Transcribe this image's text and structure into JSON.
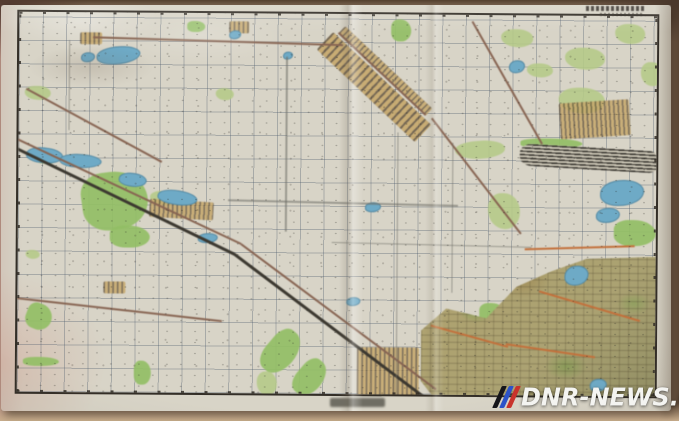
{
  "meta": {
    "description": "Photograph of a paper topographic map sheet on a table; map lettering is illegible at this resolution",
    "watermark": {
      "text": "DNR-NEWS.COM",
      "logo": "three-slanted-stripes-flag"
    }
  },
  "palette": {
    "table": "#b59a82",
    "table-dark": "#553b31",
    "table-pink": "#c39a8d",
    "table-bottom": "#c9ae8d",
    "paper": "#d8d4c7",
    "frame": "#332e27",
    "grid": "rgba(76,90,108,0.35)",
    "forest": "#b4cb82",
    "forest-bright": "#90c05e",
    "water": "#6aabc9",
    "urban-fill": "#c9a866",
    "urban-hatch": "rgba(80,62,38,0.8)",
    "city-base": "#aca26e",
    "rail": "#3c382f",
    "road": "#8a6450",
    "highway": "#c96f35",
    "track": "#6f6f68",
    "wm-text": "#f4f4f1",
    "wm-black": "#15151a",
    "wm-blue": "#2c53c8",
    "wm-red": "#c8332b"
  },
  "map": {
    "grid_spacing_px": 23.5,
    "features": [
      {
        "n": "forest-patch",
        "k": "forest",
        "x": 6,
        "y": 74,
        "w": 26,
        "h": 14
      },
      {
        "n": "forest-patch",
        "k": "forest2",
        "x": 168,
        "y": 8,
        "w": 18,
        "h": 11
      },
      {
        "n": "forest-patch",
        "k": "forest2",
        "x": 372,
        "y": 5,
        "w": 20,
        "h": 22
      },
      {
        "n": "forest-patch",
        "k": "forest",
        "x": 482,
        "y": 14,
        "w": 32,
        "h": 18
      },
      {
        "n": "forest-patch",
        "k": "forest",
        "x": 596,
        "y": 8,
        "w": 30,
        "h": 20
      },
      {
        "n": "forest-patch",
        "k": "forest",
        "x": 540,
        "y": 72,
        "w": 46,
        "h": 26
      },
      {
        "n": "forest-patch",
        "k": "forest",
        "x": 622,
        "y": 46,
        "w": 22,
        "h": 24
      },
      {
        "n": "forest-patch",
        "k": "forest",
        "x": 546,
        "y": 32,
        "w": 40,
        "h": 22
      },
      {
        "n": "forest-patch",
        "k": "forest",
        "x": 508,
        "y": 48,
        "w": 26,
        "h": 14
      },
      {
        "n": "big-forest",
        "k": "forest2",
        "x": 60,
        "y": 164,
        "w": 66,
        "h": 58,
        "r": -8
      },
      {
        "n": "forest-patch",
        "k": "forest2",
        "x": 92,
        "y": 213,
        "w": 40,
        "h": 22
      },
      {
        "n": "forest-patch",
        "k": "forest",
        "x": 12,
        "y": 136,
        "w": 30,
        "h": 16
      },
      {
        "n": "forest-patch",
        "k": "forest",
        "x": 132,
        "y": 178,
        "w": 30,
        "h": 14
      },
      {
        "n": "forest-patch",
        "k": "forest",
        "x": 436,
        "y": 128,
        "w": 50,
        "h": 18,
        "r": -5
      },
      {
        "n": "forest-patch",
        "k": "forest",
        "x": 470,
        "y": 178,
        "w": 32,
        "h": 36
      },
      {
        "n": "forest-patch",
        "k": "forest2",
        "x": 596,
        "y": 204,
        "w": 42,
        "h": 26
      },
      {
        "n": "forest-strip",
        "k": "forest2",
        "x": 502,
        "y": 123,
        "w": 62,
        "h": 10
      },
      {
        "n": "forest-strip",
        "k": "forest2",
        "x": 268,
        "y": 310,
        "w": 30,
        "h": 48,
        "r": 40
      },
      {
        "n": "forest-strip",
        "k": "forest2",
        "x": 296,
        "y": 340,
        "w": 26,
        "h": 40,
        "r": 40
      },
      {
        "n": "forest-patch",
        "k": "forest",
        "x": 240,
        "y": 358,
        "w": 20,
        "h": 24
      },
      {
        "n": "city-park",
        "k": "forest2",
        "x": 462,
        "y": 288,
        "w": 26,
        "h": 20
      },
      {
        "n": "city-park",
        "k": "forest2",
        "x": 524,
        "y": 318,
        "w": 30,
        "h": 22
      },
      {
        "n": "city-park",
        "k": "forest2",
        "x": 594,
        "y": 338,
        "w": 28,
        "h": 20
      },
      {
        "n": "city-park",
        "k": "forest2",
        "x": 634,
        "y": 288,
        "w": 20,
        "h": 26
      },
      {
        "n": "city-park",
        "k": "forest2",
        "x": 574,
        "y": 248,
        "w": 24,
        "h": 16
      },
      {
        "n": "forest-patch",
        "k": "forest",
        "x": 197,
        "y": 75,
        "w": 18,
        "h": 12
      },
      {
        "n": "forest-ribbon",
        "k": "forest2",
        "x": 14,
        "y": 288,
        "w": 26,
        "h": 26,
        "r": 20
      },
      {
        "n": "forest-strip",
        "k": "forest2",
        "x": 6,
        "y": 345,
        "w": 36,
        "h": 9
      },
      {
        "n": "forest-patch",
        "k": "forest2",
        "x": 117,
        "y": 348,
        "w": 17,
        "h": 24
      },
      {
        "n": "forest-patch",
        "k": "forest",
        "x": 8,
        "y": 238,
        "w": 14,
        "h": 9
      },
      {
        "n": "city-area",
        "k": "city",
        "x": 404,
        "y": 240,
        "w": 250,
        "h": 158
      },
      {
        "n": "settlement-band",
        "k": "urban",
        "x": 314,
        "y": 18,
        "w": 135,
        "h": 24,
        "r": 43
      },
      {
        "n": "settlement-band",
        "k": "village",
        "x": 326,
        "y": 12,
        "w": 120,
        "h": 10,
        "r": 43
      },
      {
        "n": "settlement",
        "k": "village",
        "x": 540,
        "y": 88,
        "w": 70,
        "h": 36,
        "r": -4
      },
      {
        "n": "railway-yard",
        "k": "railyard",
        "x": 502,
        "y": 128,
        "w": 140,
        "h": 22,
        "r": 3
      },
      {
        "n": "suburb-blocks",
        "k": "village",
        "x": 340,
        "y": 333,
        "w": 62,
        "h": 48
      },
      {
        "n": "hamlet",
        "k": "village",
        "x": 61,
        "y": 20,
        "w": 22,
        "h": 12
      },
      {
        "n": "village-row",
        "k": "village",
        "x": 132,
        "y": 186,
        "w": 64,
        "h": 18,
        "r": 3
      },
      {
        "n": "hamlet",
        "k": "village",
        "x": 86,
        "y": 269,
        "w": 22,
        "h": 12
      },
      {
        "n": "hamlet",
        "k": "village",
        "x": 210,
        "y": 8,
        "w": 20,
        "h": 12
      },
      {
        "n": "lake",
        "k": "water",
        "x": 77,
        "y": 35,
        "w": 42,
        "h": 16,
        "r": -3
      },
      {
        "n": "lake",
        "k": "water",
        "x": 62,
        "y": 40,
        "w": 12,
        "h": 8
      },
      {
        "n": "river-lake",
        "k": "water",
        "x": 9,
        "y": 133,
        "w": 35,
        "h": 14,
        "r": 8
      },
      {
        "n": "river-lake",
        "k": "water",
        "x": 42,
        "y": 140,
        "w": 40,
        "h": 12,
        "r": 5
      },
      {
        "n": "river-lake",
        "k": "water",
        "x": 102,
        "y": 158,
        "w": 26,
        "h": 12,
        "r": 10
      },
      {
        "n": "river-lake",
        "k": "water",
        "x": 141,
        "y": 174,
        "w": 38,
        "h": 13,
        "r": 10
      },
      {
        "n": "river-lake",
        "k": "water",
        "x": 180,
        "y": 220,
        "w": 18,
        "h": 8
      },
      {
        "n": "pond",
        "k": "water",
        "x": 582,
        "y": 164,
        "w": 42,
        "h": 24
      },
      {
        "n": "pond",
        "k": "water",
        "x": 578,
        "y": 192,
        "w": 22,
        "h": 13
      },
      {
        "n": "pond",
        "k": "water",
        "x": 547,
        "y": 250,
        "w": 22,
        "h": 18
      },
      {
        "n": "pond",
        "k": "water",
        "x": 490,
        "y": 45,
        "w": 14,
        "h": 11
      },
      {
        "n": "pond",
        "k": "water",
        "x": 573,
        "y": 363,
        "w": 15,
        "h": 11
      },
      {
        "n": "pond",
        "k": "water",
        "x": 210,
        "y": 17,
        "w": 10,
        "h": 7
      },
      {
        "n": "pond",
        "k": "water",
        "x": 264,
        "y": 38,
        "w": 8,
        "h": 6
      },
      {
        "n": "pond",
        "k": "water",
        "x": 347,
        "y": 188,
        "w": 14,
        "h": 8
      },
      {
        "n": "pond",
        "k": "water",
        "x": 329,
        "y": 283,
        "w": 12,
        "h": 7
      },
      {
        "n": "railway-line",
        "k": "rail",
        "x": -4,
        "y": 134,
        "w": 246,
        "h": 2.5,
        "r": 25.5
      },
      {
        "n": "railway-line",
        "k": "rail",
        "x": 218,
        "y": 240,
        "w": 241,
        "h": 2.5,
        "r": 36.6
      },
      {
        "n": "main-road",
        "k": "road",
        "x": -6,
        "y": 124,
        "w": 253,
        "h": 2,
        "r": 24.7
      },
      {
        "n": "main-road",
        "k": "road",
        "x": 224,
        "y": 230,
        "w": 243,
        "h": 2,
        "r": 36.3
      },
      {
        "n": "road",
        "k": "road",
        "x": 74,
        "y": 24,
        "w": 250,
        "h": 2,
        "r": 1.4
      },
      {
        "n": "road",
        "k": "road",
        "x": 320,
        "y": 18,
        "w": 120,
        "h": 1.5,
        "r": 43
      },
      {
        "n": "road",
        "k": "road",
        "x": 414,
        "y": 103,
        "w": 146,
        "h": 2,
        "r": 52
      },
      {
        "n": "road",
        "k": "road",
        "x": 454,
        "y": 6,
        "w": 141,
        "h": 1.8,
        "r": 60
      },
      {
        "n": "road",
        "k": "road",
        "x": 8,
        "y": 76,
        "w": 154,
        "h": 1.8,
        "r": 28
      },
      {
        "n": "road",
        "k": "road",
        "x": -14,
        "y": 284,
        "w": 220,
        "h": 1.8,
        "r": 6
      },
      {
        "n": "highway",
        "k": "highway",
        "x": 414,
        "y": 310,
        "w": 80,
        "h": 2,
        "r": 15
      },
      {
        "n": "highway",
        "k": "highway",
        "x": 489,
        "y": 328,
        "w": 90,
        "h": 2,
        "r": 8
      },
      {
        "n": "highway",
        "k": "highway",
        "x": 507,
        "y": 233,
        "w": 110,
        "h": 2,
        "r": -2
      },
      {
        "n": "highway",
        "k": "highway",
        "x": 522,
        "y": 275,
        "w": 105,
        "h": 2,
        "r": 16
      },
      {
        "n": "field-line",
        "k": "track",
        "x": 267,
        "y": 43,
        "w": 1.5,
        "h": 175
      },
      {
        "n": "field-line",
        "k": "track",
        "x": 50,
        "y": 28,
        "w": 1.2,
        "h": 90
      },
      {
        "n": "field-line",
        "k": "track",
        "x": 379,
        "y": 118,
        "w": 1.2,
        "h": 270
      },
      {
        "n": "field-line",
        "k": "track",
        "x": 434,
        "y": 128,
        "w": 1.2,
        "h": 150
      },
      {
        "n": "field-line",
        "k": "track",
        "x": 210,
        "y": 186,
        "w": 230,
        "h": 1.5,
        "r": 1
      },
      {
        "n": "field-line",
        "k": "track",
        "x": 314,
        "y": 228,
        "w": 200,
        "h": 1.2,
        "r": 1
      }
    ]
  }
}
